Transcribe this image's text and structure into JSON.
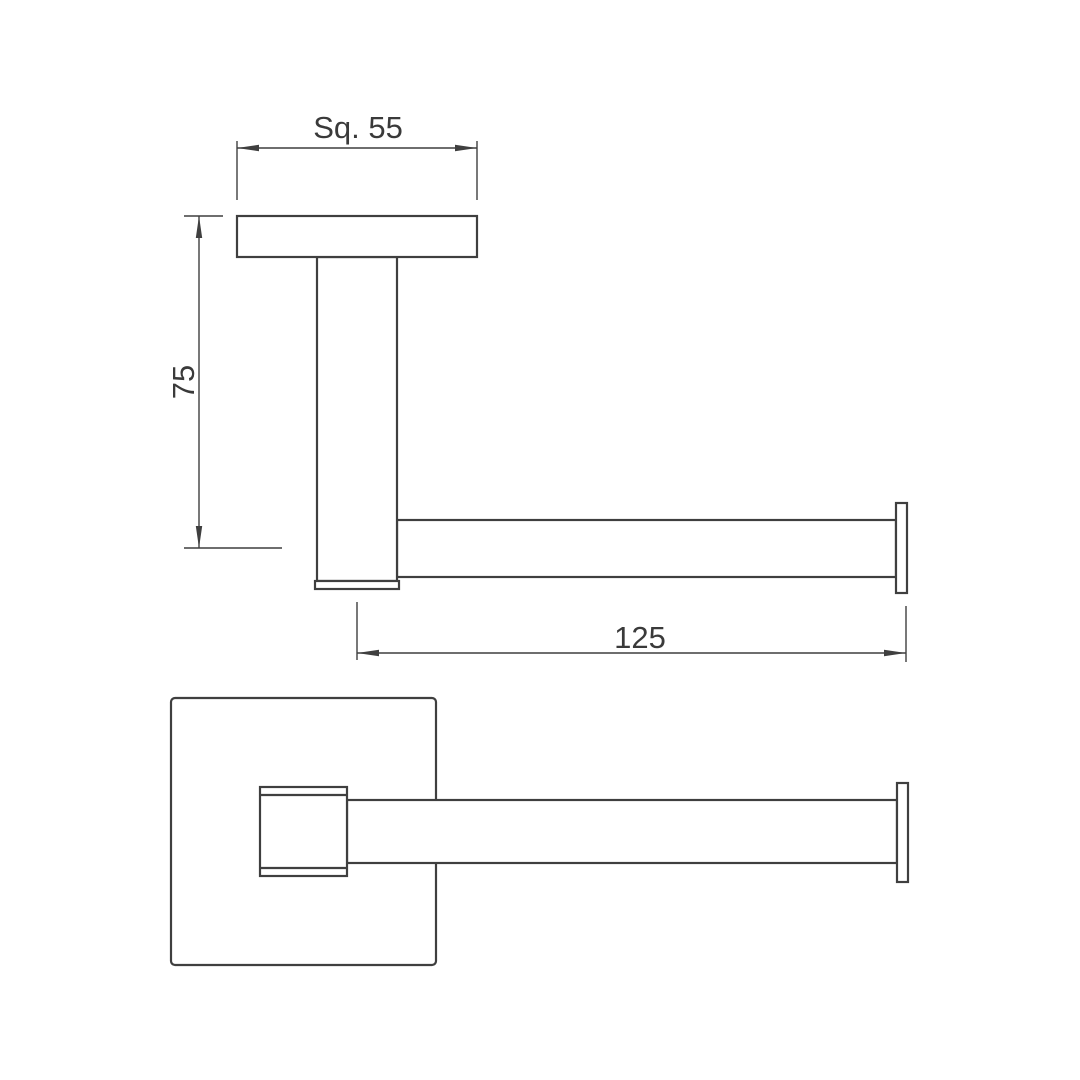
{
  "page": {
    "background_color": "#ffffff",
    "line_color": "#3f3f3f",
    "text_color": "#3a3a3a"
  },
  "drawing": {
    "type": "technical_dimension_drawing",
    "views": [
      {
        "id": "side-elevation",
        "position": "top",
        "parts": [
          "wall-plate",
          "mounting-post",
          "post-base-cap",
          "roll-bar",
          "end-cap"
        ]
      },
      {
        "id": "plan-view",
        "position": "bottom",
        "parts": [
          "wall-plate",
          "mounting-post",
          "post-cap-edges",
          "roll-bar",
          "end-cap"
        ]
      }
    ],
    "dimensions": [
      {
        "id": "plate-square-size",
        "label": "Sq. 55",
        "value": 55,
        "orientation": "horizontal"
      },
      {
        "id": "projection-height",
        "label": "75",
        "value": 75,
        "orientation": "vertical"
      },
      {
        "id": "bar-length",
        "label": "125",
        "value": 125,
        "orientation": "horizontal"
      }
    ]
  }
}
